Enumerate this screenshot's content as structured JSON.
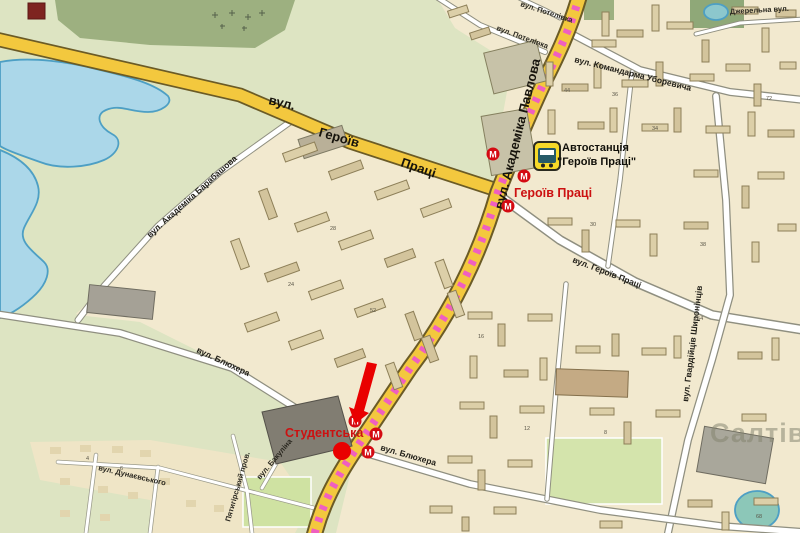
{
  "map": {
    "streets": {
      "heroiv_pratsi_w": [
        "вул.",
        "Героїв",
        "Праці"
      ],
      "akademika_pavlova": "вул. Академіка Павлова",
      "komandarma_uborevycha": "вул. Командарма Уборевича",
      "dzherelna": "Джерельна вул.",
      "potelivka": "вул. Потелівка",
      "akademika_barabashova": "вул. Академіка Барабашова",
      "heroiv_pratsi_e": "вул. Героїв Праці",
      "hvardiytsiv_shyronintsiv": "вул. Гвардійців Широнінців",
      "bliukhera": "вул. Блюхера",
      "dunaievskoho": "вул. Дунаєвського",
      "piatyhirskyi": "Пятигірський пров.",
      "bakulina": "вул. Бакуліна"
    },
    "labels": {
      "bus_station_line1": "Автостанція",
      "bus_station_line2": "\"Героїв Праці\"",
      "metro_heroiv_pratsi": "Героїв Праці",
      "metro_studentska": "Студентська",
      "watermark": "Салтів"
    },
    "metro_m": "М",
    "house_numbers": [
      {
        "t": "254",
        "x": 694,
        "y": 320
      },
      {
        "t": "36",
        "x": 612,
        "y": 96
      },
      {
        "t": "34",
        "x": 652,
        "y": 130
      },
      {
        "t": "30",
        "x": 590,
        "y": 226
      },
      {
        "t": "38",
        "x": 700,
        "y": 246
      },
      {
        "t": "44",
        "x": 564,
        "y": 92
      },
      {
        "t": "16",
        "x": 478,
        "y": 338
      },
      {
        "t": "12",
        "x": 524,
        "y": 430
      },
      {
        "t": "8",
        "x": 604,
        "y": 434
      },
      {
        "t": "28",
        "x": 330,
        "y": 230
      },
      {
        "t": "52",
        "x": 370,
        "y": 312
      },
      {
        "t": "72",
        "x": 766,
        "y": 100
      },
      {
        "t": "68",
        "x": 756,
        "y": 518
      },
      {
        "t": "24",
        "x": 288,
        "y": 286
      },
      {
        "t": "6",
        "x": 120,
        "y": 470
      },
      {
        "t": "4",
        "x": 86,
        "y": 460
      }
    ],
    "colors": {
      "metro_red": "#d40a12",
      "label_red": "#cc1111",
      "road_yellow": "#f3c83e",
      "tram_pink": "#ef5fc0",
      "water_fill": "#abd7e9",
      "water_edge": "#4d9fc4",
      "park_green": "#dde4c2",
      "forest_green": "#9db080",
      "field_green": "#cfe2a2",
      "bg_cream": "#f2e9cf",
      "building_fill": "#dccfa8",
      "arrow_red": "#e90000",
      "bus_yellow": "#f6d929",
      "watermark_gray": "#83836f"
    }
  }
}
